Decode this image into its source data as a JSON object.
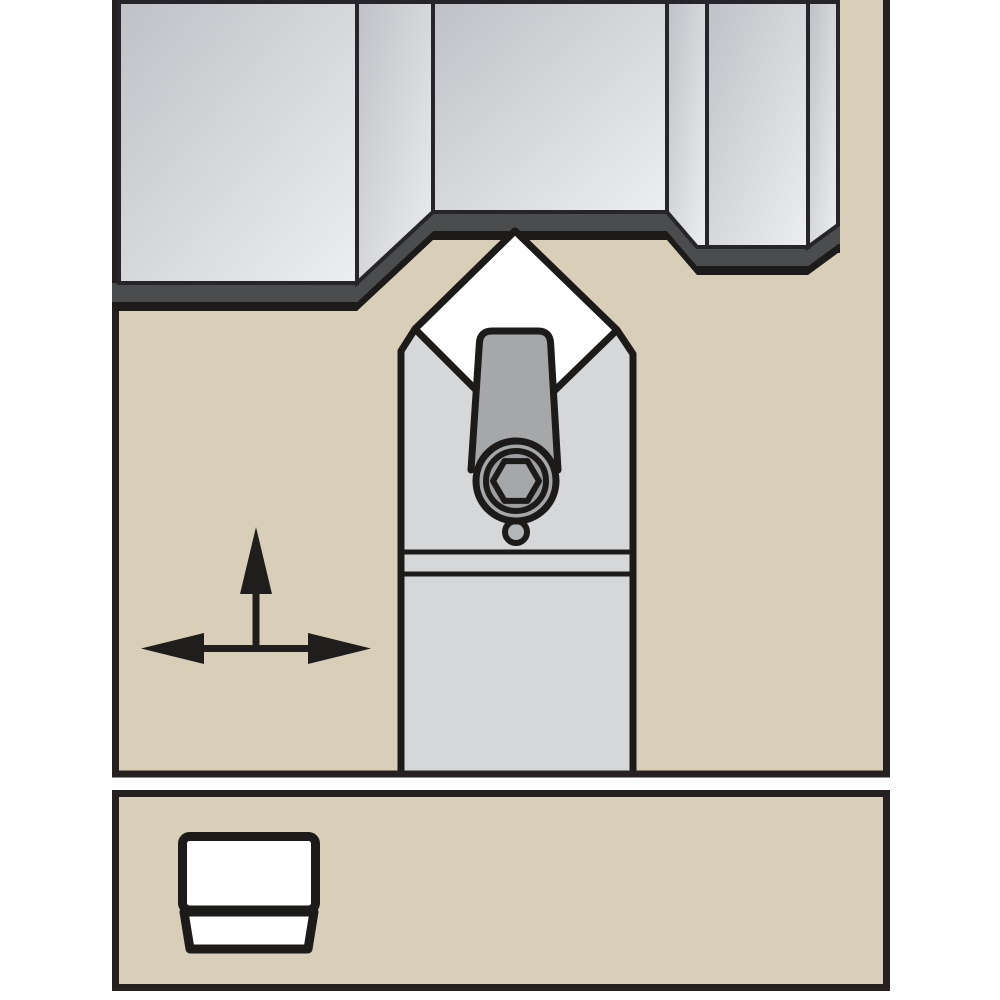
{
  "illustration": {
    "kind": "turning-toolholder-application-diagram",
    "text_content": "none"
  },
  "colors": {
    "page_bg": "#ffffff",
    "panel_fill": "#d9cfb9",
    "panel_border": "#262120",
    "outline": "#1c1b1a",
    "workpiece_grad_dark": "#bfc1c6",
    "workpiece_grad_light": "#edeef0",
    "workpiece_edge": "#26262a",
    "chip_band": "#4b4c4e",
    "holder_fill": "#d6d7d9",
    "insert_fill": "#ffffff",
    "clamp_fill": "#a6a7a9",
    "clamp_bore_fill": "#9c9da0",
    "clamp_nub_fill": "#b4b5b7",
    "arrow": "#1f1e1d"
  }
}
